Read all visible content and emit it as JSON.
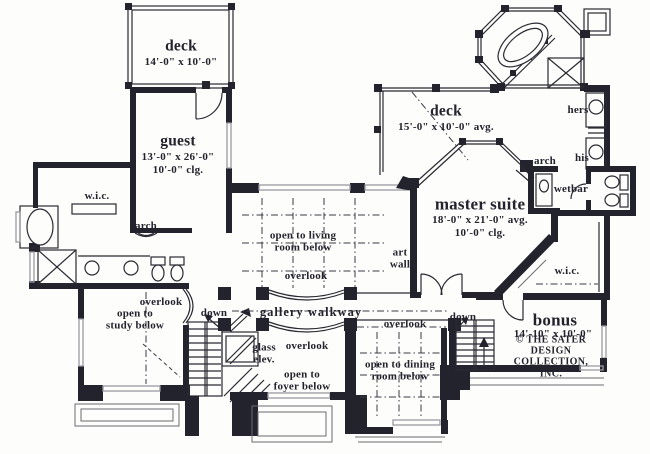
{
  "rooms": {
    "deck_upper": {
      "name": "deck",
      "dims": "14'-0\" x 10'-0\""
    },
    "guest": {
      "name": "guest",
      "dims": "13'-0\" x 26'-0\"",
      "clg": "10'-0\" clg."
    },
    "deck_master": {
      "name": "deck",
      "dims": "15'-0\" x 10'-0\" avg."
    },
    "master": {
      "name": "master suite",
      "dims": "18'-0\" x 21'-0\" avg.",
      "clg": "10'-0\" clg."
    },
    "bonus": {
      "name": "bonus",
      "dims": "14'-10\" x 10'-0\""
    }
  },
  "open_areas": {
    "living": "open to living\nroom below",
    "study": "open to\nstudy below",
    "foyer": "open to\nfoyer below",
    "dining": "open to dining\nroom below",
    "gallery": "gallery  walkway"
  },
  "annotations": {
    "overlook_left": "overlook",
    "overlook_living": "overlook",
    "overlook_gallery": "overlook",
    "overlook_dining": "overlook",
    "down_left": "down",
    "down_right": "down",
    "wic_left": "w.i.c.",
    "wic_right": "w.i.c.",
    "arch_left": "arch",
    "arch_right": "arch",
    "hers": "hers",
    "his": "his",
    "wetbar": "wetbar",
    "glass_elev": "glass\nelev.",
    "art_wall": "art\nwall"
  },
  "credit": "© THE SATER DESIGN\nCOLLECTION, INC.",
  "colors": {
    "ink": "#23232e",
    "wall": "#23232e",
    "window": "#9a9aa2",
    "background": "#fdfdfb"
  }
}
